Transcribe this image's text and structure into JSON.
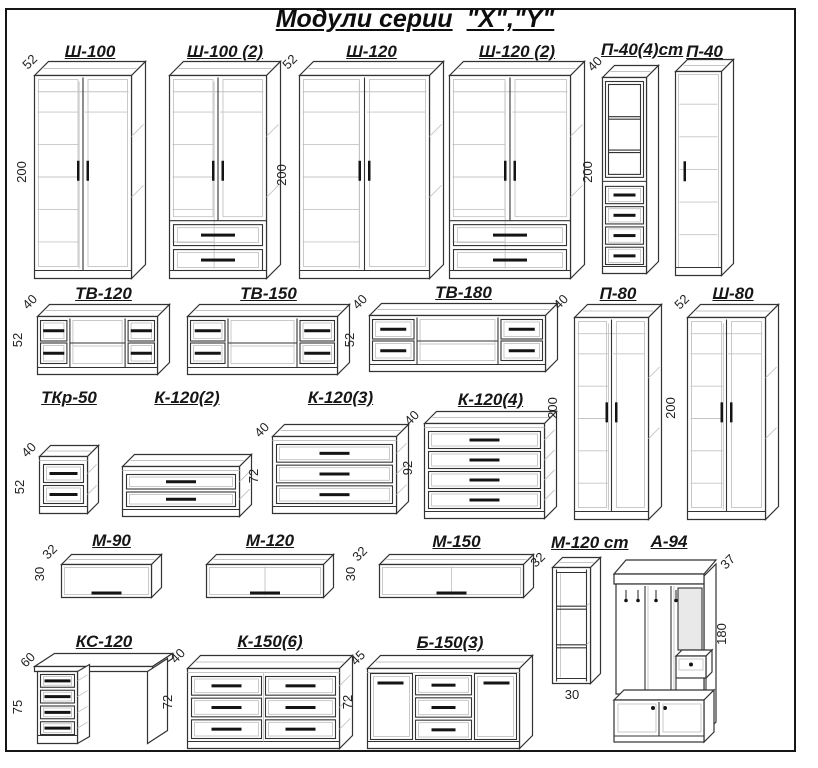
{
  "title": {
    "main": "Модули серии",
    "series": "\"X\",\"Y\""
  },
  "modules": [
    {
      "label": "Ш-100",
      "kind": "two-door-wardrobe",
      "depth": "52",
      "height": "200"
    },
    {
      "label": "Ш-100 (2)",
      "kind": "two-door-wardrobe-2-drawers"
    },
    {
      "label": "Ш-120",
      "kind": "two-door-wardrobe",
      "depth": "52",
      "height": "200"
    },
    {
      "label": "Ш-120 (2)",
      "kind": "two-door-wardrobe-2-drawers"
    },
    {
      "label": "П-40(4)ст",
      "kind": "display-cabinet-4-drawers",
      "depth": "40",
      "height": "200"
    },
    {
      "label": "П-40",
      "kind": "single-door-cabinet"
    },
    {
      "label": "ТВ-120",
      "kind": "tv-stand",
      "depth": "40",
      "height": "52"
    },
    {
      "label": "ТВ-150",
      "kind": "tv-stand"
    },
    {
      "label": "ТВ-180",
      "kind": "tv-stand",
      "depth": "40",
      "height": "52"
    },
    {
      "label": "П-80",
      "kind": "two-door-cabinet",
      "depth": "40",
      "height": "200"
    },
    {
      "label": "Ш-80",
      "kind": "two-door-wardrobe",
      "depth": "52",
      "height": "200"
    },
    {
      "label": "ТКр-50",
      "kind": "bedside-chest-2-drawers",
      "depth": "40",
      "height": "52"
    },
    {
      "label": "К-120(2)",
      "kind": "chest-2-drawers"
    },
    {
      "label": "К-120(3)",
      "kind": "chest-3-drawers",
      "depth": "40",
      "height": "72"
    },
    {
      "label": "К-120(4)",
      "kind": "chest-4-drawers",
      "depth": "40",
      "height": "92"
    },
    {
      "label": "М-90",
      "kind": "wall-cabinet",
      "depth": "32",
      "height": "30"
    },
    {
      "label": "М-120",
      "kind": "wall-cabinet"
    },
    {
      "label": "М-150",
      "kind": "wall-cabinet",
      "depth": "32",
      "height": "30"
    },
    {
      "label": "М-120 ст",
      "kind": "open-shelf-column",
      "depth": "32",
      "width": "30"
    },
    {
      "label": "А-94",
      "kind": "hallway-stand",
      "depth": "37",
      "height": "180"
    },
    {
      "label": "КС-120",
      "kind": "desk-4-drawers",
      "depth": "60",
      "height": "75"
    },
    {
      "label": "К-150(6)",
      "kind": "chest-6-drawers",
      "depth": "40",
      "height": "72"
    },
    {
      "label": "Б-150(3)",
      "kind": "sideboard-2-doors-3-drawers",
      "depth": "45",
      "height": "72"
    }
  ]
}
